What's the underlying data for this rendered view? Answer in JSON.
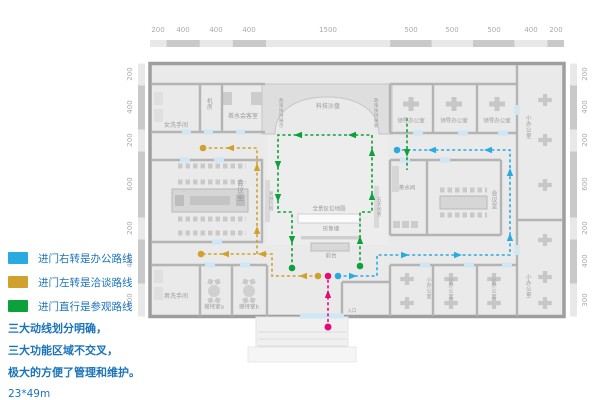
{
  "rulers": {
    "top": [
      "200",
      "400",
      "400",
      "400",
      "1500",
      "500",
      "500",
      "500",
      "400",
      "200"
    ],
    "left": [
      "200",
      "400",
      "200",
      "600",
      "200",
      "400",
      "300"
    ],
    "right": [
      "200",
      "400",
      "200",
      "600",
      "200",
      "400",
      "300"
    ]
  },
  "routes": {
    "office": {
      "color": "#29abe2",
      "legend": "进门右转是办公路线"
    },
    "talk": {
      "color": "#d0a12d",
      "legend": "进门左转是洽谈路线"
    },
    "tour": {
      "color": "#0ca13a",
      "legend": "进门直行是参观路线"
    },
    "entry": {
      "color": "#e40a77"
    }
  },
  "notes": {
    "line1": "三大动线划分明确，",
    "line2": "三大功能区域不交叉，",
    "line3": "极大的方便了管理和维护。",
    "size": "23*49m"
  },
  "rooms": {
    "women_restroom": "女洗手间",
    "machine_room": "机房",
    "tea_reception": "茶水会客室",
    "tech_sandbox": "科技沙盘",
    "policy_display_left": "政策扶持展示",
    "policy_display_right": "政策扶持展板",
    "meeting_room": "会议室",
    "dev_history": "发展历程",
    "five_advantages": "五大优势",
    "panorama_map": "全景区位地图",
    "image_wall": "形象墙",
    "front_desk": "前台",
    "men_restroom": "男洗手间",
    "reception_a": "接待室a",
    "reception_b": "接待室b",
    "entrance": "入口",
    "leader_office": "领导办公室",
    "small_office": "小办公室",
    "tea_room": "茶水间",
    "meeting_room2": "会议室"
  }
}
